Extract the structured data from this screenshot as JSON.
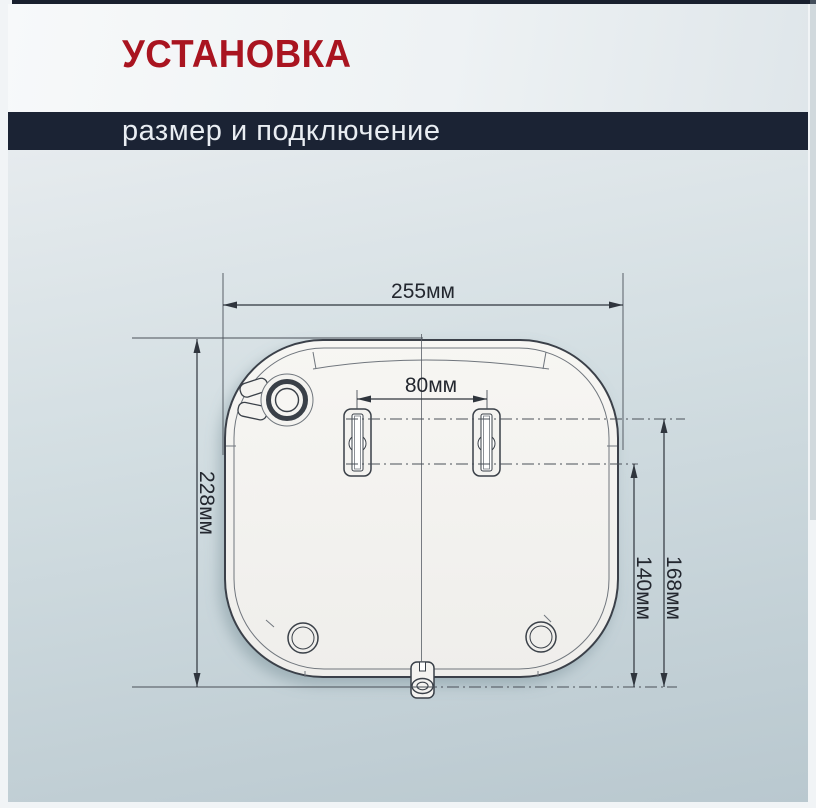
{
  "header": {
    "title": "УСТАНОВКА",
    "title_color": "#a91420"
  },
  "subheader": {
    "label": "размер и подключение",
    "bg_color": "#1b2334",
    "text_color": "#e9edf2"
  },
  "diagram": {
    "type": "technical-drawing",
    "subject": "back view of water heater with wall-mount dimensions",
    "line_color": "#2f353d",
    "body_fill": "#f4f3f0",
    "dimensions": {
      "overall_width": "255мм",
      "mount_spacing": "80мм",
      "overall_height": "228мм",
      "lower_mount_height": "140мм",
      "upper_mount_height": "168мм"
    }
  }
}
